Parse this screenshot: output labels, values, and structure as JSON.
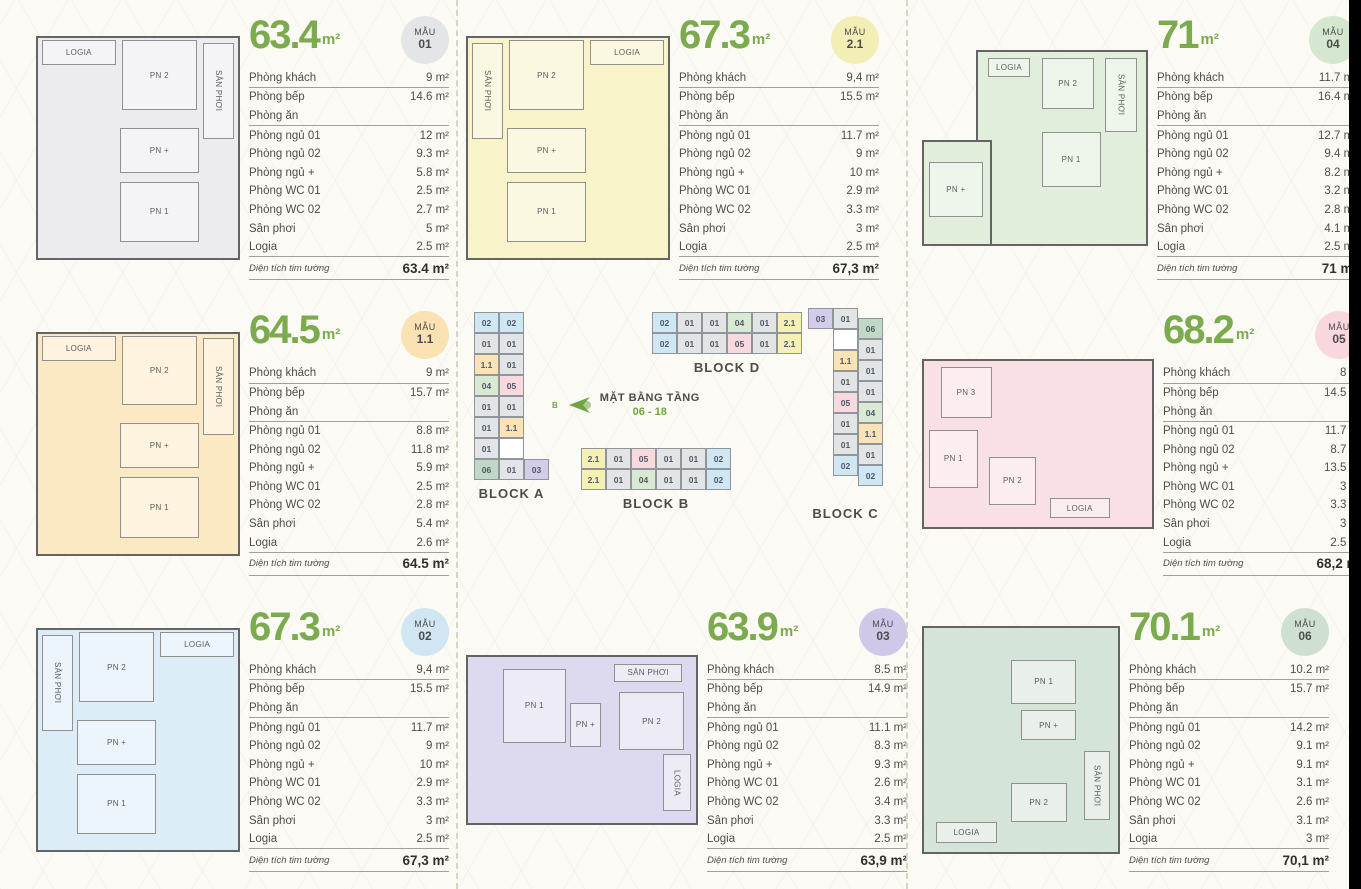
{
  "page": {
    "background": "#fbfaf4",
    "accent_green": "#7caa4e",
    "text_color": "#4d4d4d",
    "right_edge_bar_color": "#000000"
  },
  "badge_label": "MẪU",
  "spec_labels": [
    "Phòng khách",
    "Phòng bếp",
    "Phòng ăn",
    "Phòng ngủ 01",
    "Phòng ngủ 02",
    "Phòng ngủ +",
    "Phòng WC 01",
    "Phòng WC 02",
    "Sân phơi",
    "Logia"
  ],
  "total_label": "Diện tích tim tường",
  "units": [
    {
      "area": "63.4",
      "area_unit": "m²",
      "model": "01",
      "badge_color": "#e4e5e7",
      "plan_color": "#ececee",
      "variant": "a",
      "values": [
        "9 m²",
        "14.6 m²",
        "",
        "12 m²",
        "9.3 m²",
        "5.8 m²",
        "2.5 m²",
        "2.7 m²",
        "5 m²",
        "2.5 m²"
      ],
      "total": "63.4 m²",
      "rooms": [
        {
          "label": "LOGIA",
          "x": 3,
          "y": 2,
          "w": 36,
          "h": 11
        },
        {
          "label": "PN 2",
          "x": 42,
          "y": 2,
          "w": 37,
          "h": 31
        },
        {
          "label": "SÂN PHƠI",
          "x": 82,
          "y": 3,
          "w": 15,
          "h": 43,
          "vertical": true
        },
        {
          "label": "PN +",
          "x": 41,
          "y": 41,
          "w": 39,
          "h": 20
        },
        {
          "label": "PN 1",
          "x": 41,
          "y": 65,
          "w": 39,
          "h": 27
        }
      ]
    },
    {
      "area": "67.3",
      "area_unit": "m²",
      "model": "2.1",
      "badge_color": "#f3eeb5",
      "plan_color": "#f8f3c8",
      "variant": "b",
      "values": [
        "9,4 m²",
        "15.5 m²",
        "",
        "11.7 m²",
        "9 m²",
        "10 m²",
        "2.9 m²",
        "3.3 m²",
        "3 m²",
        "2.5 m²"
      ],
      "total": "67,3 m²",
      "rooms": [
        {
          "label": "SÂN PHƠI",
          "x": 3,
          "y": 3,
          "w": 15,
          "h": 43,
          "vertical": true
        },
        {
          "label": "PN 2",
          "x": 21,
          "y": 2,
          "w": 37,
          "h": 31
        },
        {
          "label": "LOGIA",
          "x": 61,
          "y": 2,
          "w": 36,
          "h": 11
        },
        {
          "label": "PN +",
          "x": 20,
          "y": 41,
          "w": 39,
          "h": 20
        },
        {
          "label": "PN 1",
          "x": 20,
          "y": 65,
          "w": 39,
          "h": 27
        }
      ]
    },
    {
      "area": "71",
      "area_unit": "m²",
      "model": "04",
      "badge_color": "#d5e7ce",
      "plan_color": "#e1eedb",
      "variant": "l",
      "shape": [
        {
          "x": 24,
          "y": 0,
          "w": 76,
          "h": 100
        },
        {
          "x": 0,
          "y": 46,
          "w": 31,
          "h": 54
        }
      ],
      "values": [
        "11.7 m²",
        "16.4 m²",
        "",
        "12.7 m²",
        "9.4 m²",
        "8.2 m²",
        "3.2 m²",
        "2.8 m²",
        "4.1 m²",
        "2.5 m²"
      ],
      "total": "71 m²",
      "rooms": [
        {
          "label": "LOGIA",
          "x": 29,
          "y": 4,
          "w": 19,
          "h": 10
        },
        {
          "label": "PN 2",
          "x": 53,
          "y": 4,
          "w": 23,
          "h": 26
        },
        {
          "label": "SÂN PHƠI",
          "x": 81,
          "y": 4,
          "w": 14,
          "h": 38,
          "vertical": true
        },
        {
          "label": "PN 1",
          "x": 53,
          "y": 42,
          "w": 26,
          "h": 28
        },
        {
          "label": "PN +",
          "x": 3,
          "y": 57,
          "w": 24,
          "h": 28
        }
      ]
    },
    {
      "area": "64.5",
      "area_unit": "m²",
      "model": "1.1",
      "badge_color": "#fae2b3",
      "plan_color": "#fbe9c4",
      "variant": "a",
      "values": [
        "9 m²",
        "15.7 m²",
        "",
        "8.8 m²",
        "11.8 m²",
        "5.9 m²",
        "2.5 m²",
        "2.8 m²",
        "5.4 m²",
        "2.6 m²"
      ],
      "total": "64.5 m²",
      "rooms": [
        {
          "label": "LOGIA",
          "x": 3,
          "y": 2,
          "w": 36,
          "h": 11
        },
        {
          "label": "PN 2",
          "x": 42,
          "y": 2,
          "w": 37,
          "h": 31
        },
        {
          "label": "SÂN PHƠI",
          "x": 82,
          "y": 3,
          "w": 15,
          "h": 43,
          "vertical": true
        },
        {
          "label": "PN +",
          "x": 41,
          "y": 41,
          "w": 39,
          "h": 20
        },
        {
          "label": "PN 1",
          "x": 41,
          "y": 65,
          "w": 39,
          "h": 27
        }
      ]
    },
    {
      "area": "68.2",
      "area_unit": "m²",
      "model": "05",
      "badge_color": "#f8d8de",
      "plan_color": "#f9e0e4",
      "variant": "h",
      "values": [
        "8 m²",
        "14.5 m²",
        "",
        "11.7 m²",
        "8.7 m²",
        "13.5 m²",
        "3 m²",
        "3.3 m²",
        "3 m²",
        "2.5 m²"
      ],
      "total": "68,2 m²",
      "rooms": [
        {
          "label": "PN 3",
          "x": 8,
          "y": 5,
          "w": 22,
          "h": 30
        },
        {
          "label": "PN 1",
          "x": 3,
          "y": 42,
          "w": 21,
          "h": 34
        },
        {
          "label": "PN 2",
          "x": 29,
          "y": 58,
          "w": 20,
          "h": 28
        },
        {
          "label": "LOGIA",
          "x": 55,
          "y": 82,
          "w": 26,
          "h": 12
        }
      ]
    },
    {
      "area": "67.3",
      "area_unit": "m²",
      "model": "02",
      "badge_color": "#d0e6f3",
      "plan_color": "#dcedf7",
      "variant": "b",
      "values": [
        "9,4 m²",
        "15.5 m²",
        "",
        "11.7 m²",
        "9 m²",
        "10 m²",
        "2.9 m²",
        "3.3 m²",
        "3 m²",
        "2.5 m²"
      ],
      "total": "67,3 m²",
      "rooms": [
        {
          "label": "SÂN PHƠI",
          "x": 3,
          "y": 3,
          "w": 15,
          "h": 43,
          "vertical": true
        },
        {
          "label": "PN 2",
          "x": 21,
          "y": 2,
          "w": 37,
          "h": 31
        },
        {
          "label": "LOGIA",
          "x": 61,
          "y": 2,
          "w": 36,
          "h": 11
        },
        {
          "label": "PN +",
          "x": 20,
          "y": 41,
          "w": 39,
          "h": 20
        },
        {
          "label": "PN 1",
          "x": 20,
          "y": 65,
          "w": 39,
          "h": 27
        }
      ]
    },
    {
      "area": "63.9",
      "area_unit": "m²",
      "model": "03",
      "badge_color": "#cfc8e9",
      "plan_color": "#dddaef",
      "variant": "h",
      "values": [
        "8.5 m²",
        "14.9 m²",
        "",
        "11.1 m²",
        "8.3 m²",
        "9.3 m²",
        "2.6 m²",
        "3.4 m²",
        "3.3 m²",
        "2.5 m²"
      ],
      "total": "63,9 m²",
      "rooms": [
        {
          "label": "PN 1",
          "x": 16,
          "y": 8,
          "w": 27,
          "h": 44
        },
        {
          "label": "PN +",
          "x": 45,
          "y": 28,
          "w": 13,
          "h": 26
        },
        {
          "label": "SÂN PHƠI",
          "x": 64,
          "y": 5,
          "w": 29,
          "h": 11
        },
        {
          "label": "PN 2",
          "x": 66,
          "y": 22,
          "w": 28,
          "h": 34
        },
        {
          "label": "LOGIA",
          "x": 85,
          "y": 58,
          "w": 12,
          "h": 34,
          "vertical": true
        }
      ]
    },
    {
      "area": "70.1",
      "area_unit": "m²",
      "model": "06",
      "badge_color": "#cfe0d2",
      "plan_color": "#d5e4d8",
      "variant": "f",
      "values": [
        "10.2 m²",
        "15.7 m²",
        "",
        "14.2 m²",
        "9.1 m²",
        "9.1 m²",
        "3.1 m²",
        "2.6 m²",
        "3.1 m²",
        "3 m²"
      ],
      "total": "70,1 m²",
      "rooms": [
        {
          "label": "PN 1",
          "x": 45,
          "y": 15,
          "w": 33,
          "h": 19
        },
        {
          "label": "PN +",
          "x": 50,
          "y": 37,
          "w": 28,
          "h": 13
        },
        {
          "label": "PN 2",
          "x": 45,
          "y": 69,
          "w": 28,
          "h": 17
        },
        {
          "label": "SÂN PHƠI",
          "x": 82,
          "y": 55,
          "w": 13,
          "h": 30,
          "vertical": true
        },
        {
          "label": "LOGIA",
          "x": 7,
          "y": 86,
          "w": 31,
          "h": 9
        }
      ]
    }
  ],
  "diagram": {
    "title": "MẶT BẰNG TẦNG",
    "subtitle": "06 - 18",
    "compass_label": "B",
    "compass_color": "#6fa440",
    "cell_colors": {
      "01": "#e3e4e6",
      "02": "#cfe6f3",
      "03": "#d3cdea",
      "04": "#d9e9d3",
      "05": "#f7d9de",
      "06": "#c2d8c7",
      "1.1": "#fbe3b6",
      "2.1": "#f6f0b4",
      "blank": "#ffffff"
    },
    "blocks": {
      "a": {
        "label": "BLOCK A",
        "col1": [
          "02",
          "01",
          "1.1",
          "04",
          "01",
          "01",
          "01",
          "06"
        ],
        "col2": [
          "02",
          "01",
          "01",
          "05",
          "01",
          "1.1",
          "blank"
        ],
        "bottom": [
          "01",
          "03"
        ]
      },
      "b": {
        "label": "BLOCK B",
        "rows": [
          [
            "2.1",
            "01",
            "05",
            "01",
            "01",
            "02"
          ],
          [
            "2.1",
            "01",
            "04",
            "01",
            "01",
            "02"
          ]
        ]
      },
      "c": {
        "label": "BLOCK C",
        "top": [
          "03",
          "01"
        ],
        "col1": [
          "blank",
          "1.1",
          "01",
          "05",
          "01",
          "01",
          "02"
        ],
        "col2": [
          "06",
          "01",
          "01",
          "01",
          "04",
          "1.1",
          "01",
          "02"
        ]
      },
      "d": {
        "label": "BLOCK D",
        "rows": [
          [
            "02",
            "01",
            "01",
            "04",
            "01",
            "2.1"
          ],
          [
            "02",
            "01",
            "01",
            "05",
            "01",
            "2.1"
          ]
        ]
      }
    }
  }
}
